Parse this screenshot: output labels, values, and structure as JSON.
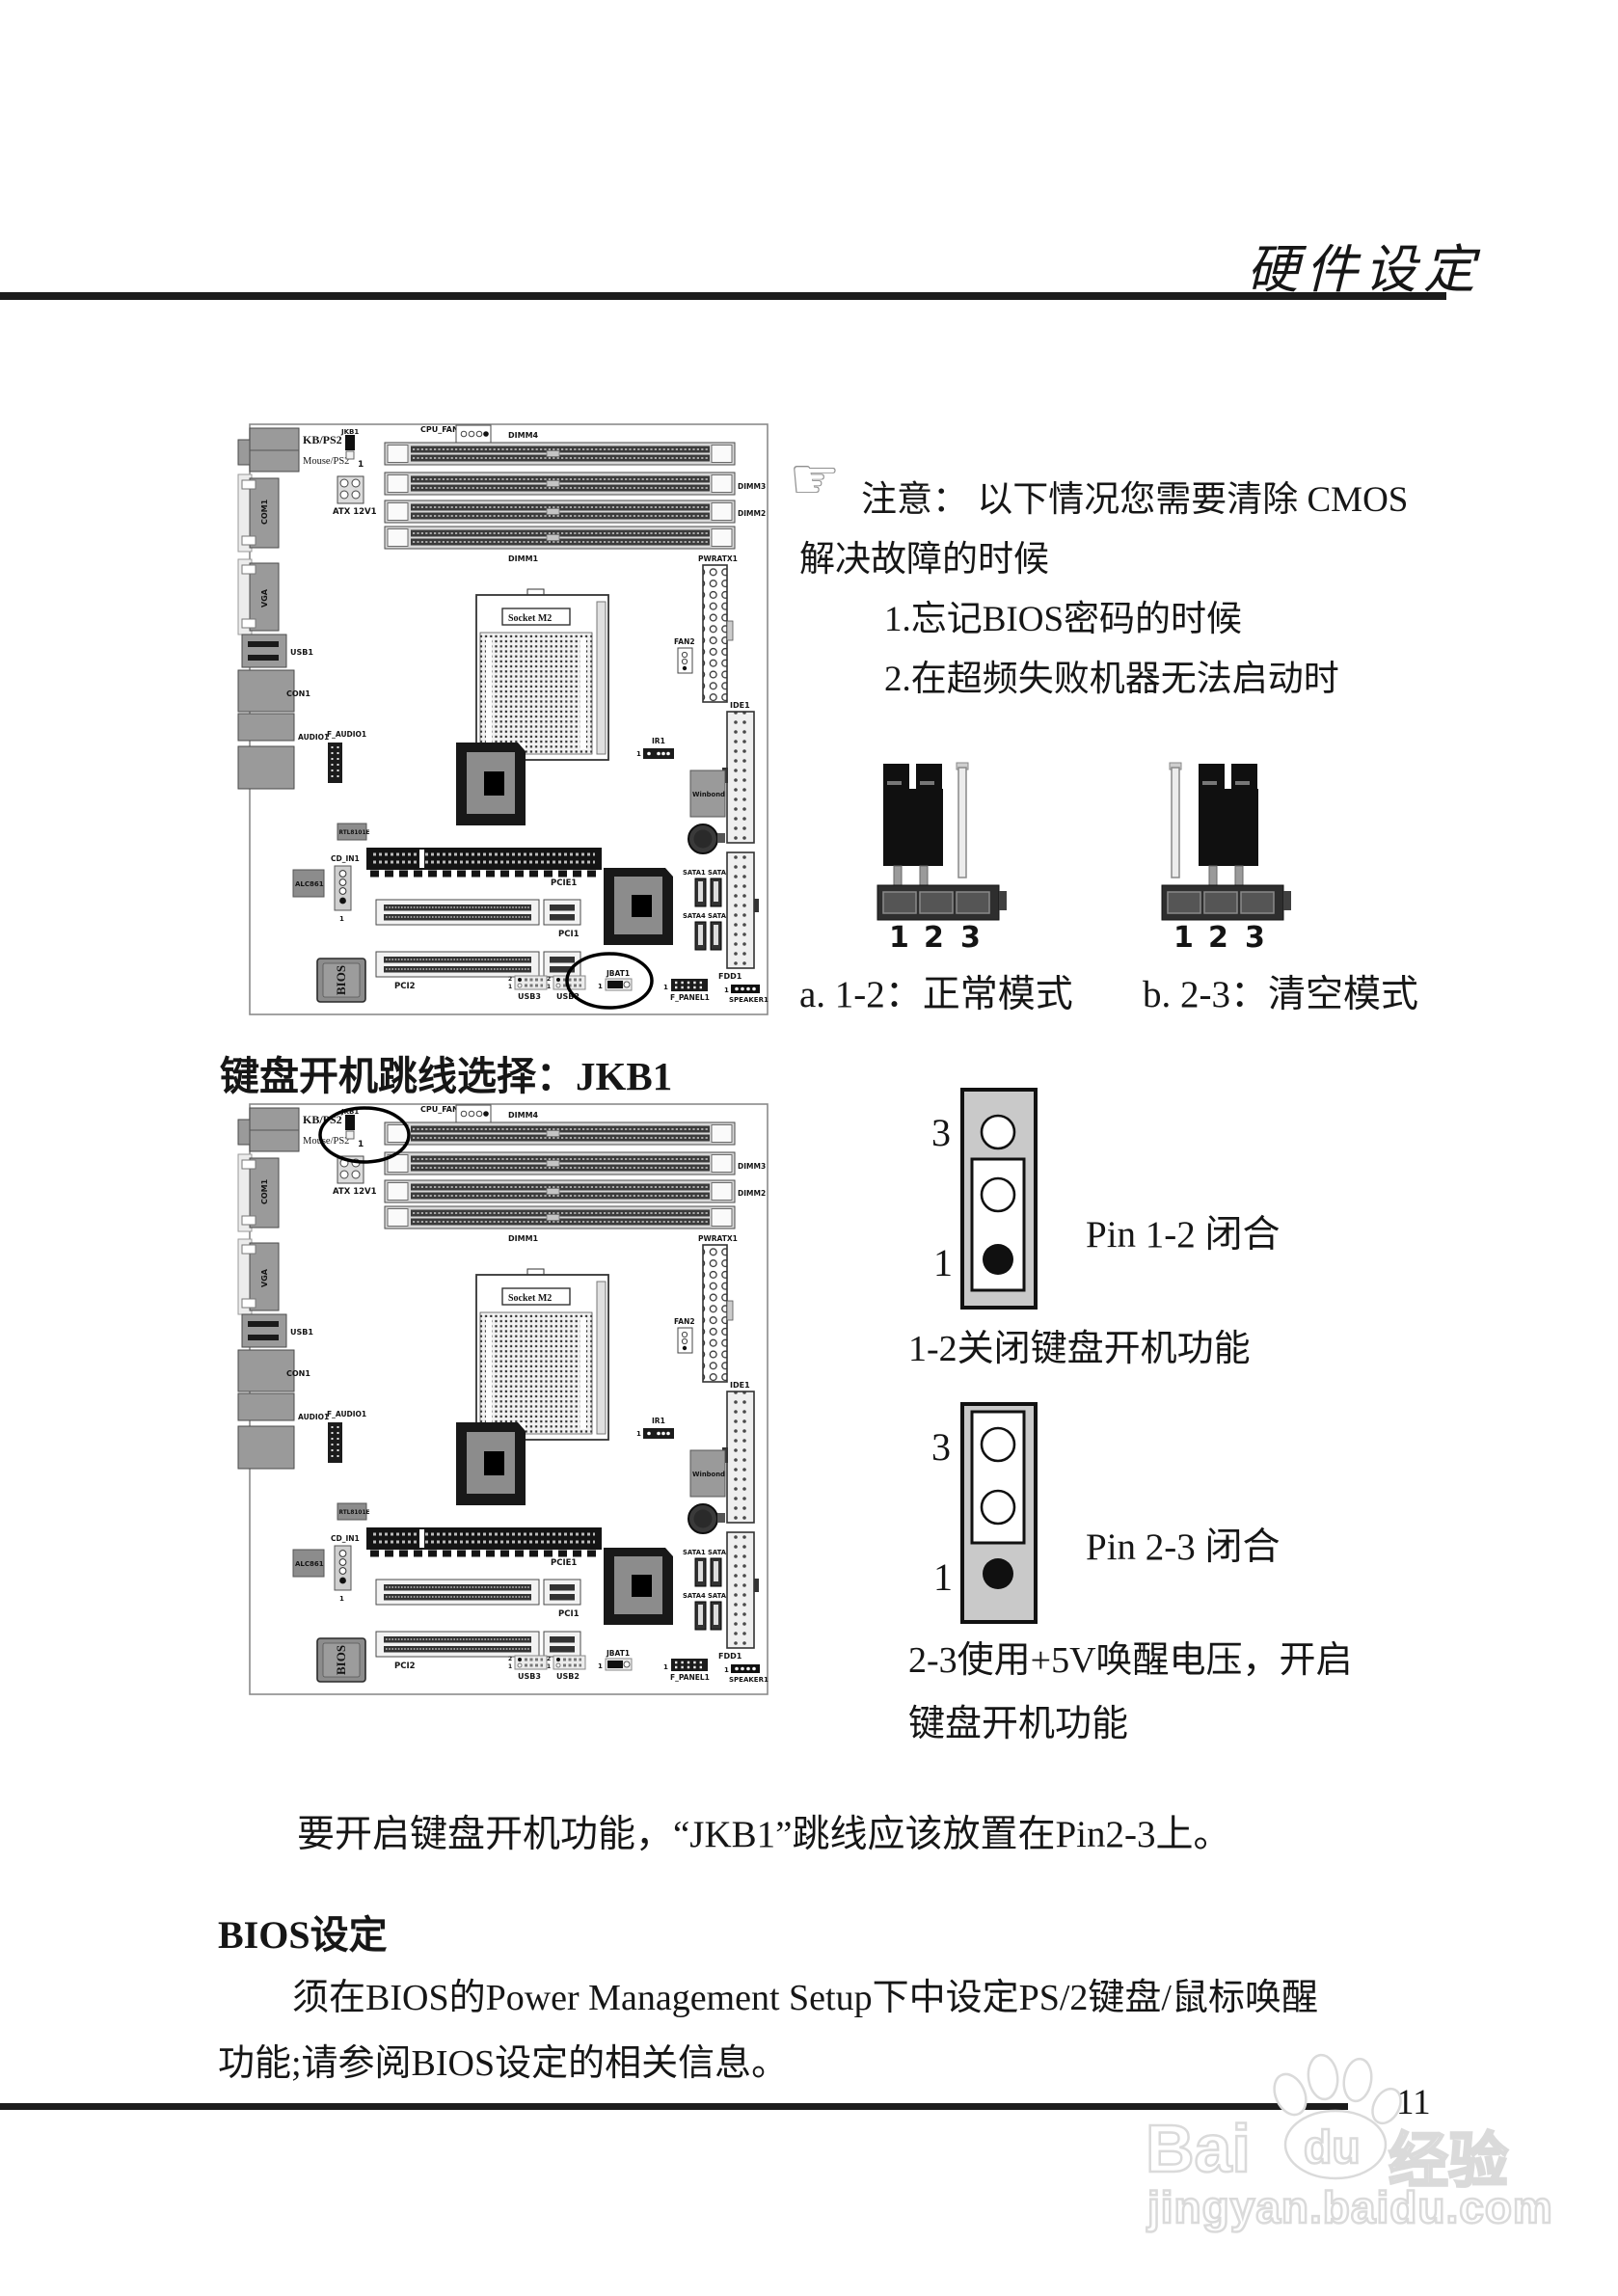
{
  "page": {
    "title": "硬件设定",
    "number": "11"
  },
  "notice": {
    "line1": "注意： 以下情况您需要清除 CMOS",
    "line2": "解决故障的时候",
    "item1": "1.忘记BIOS密码的时候",
    "item2": "2.在超频失败机器无法启动时"
  },
  "cmos_jumper": {
    "pins": [
      "1",
      "2",
      "3"
    ],
    "caption_a": "a. 1-2：正常模式",
    "caption_b": "b. 2-3：清空模式"
  },
  "jkb1": {
    "heading": "键盘开机跳线选择：JKB1",
    "diagram1": {
      "top": "3",
      "bottom": "1",
      "caption": "Pin 1-2 闭合",
      "desc": "1-2关闭键盘开机功能"
    },
    "diagram2": {
      "top": "3",
      "bottom": "1",
      "caption": "Pin 2-3 闭合",
      "desc1": "2-3使用+5V唤醒电压，开启",
      "desc2": "键盘开机功能"
    },
    "note": "要开启键盘开机功能，“JKB1”跳线应该放置在Pin2-3上。"
  },
  "bios": {
    "heading": "BIOS设定",
    "line1": "须在BIOS的Power Management Setup下中设定PS/2键盘/鼠标唤醒",
    "line2": "功能;请参阅BIOS设定的相关信息。"
  },
  "board_labels": {
    "kb_ps2": "KB/PS2",
    "mouse_ps2": "Mouse/PS2",
    "jkb1": "JKB1",
    "pin1": "1",
    "pin2": "2",
    "atx_12v": "ATX 12V1",
    "cpu_fan1": "CPU_FAN1",
    "dimm4": "DIMM4",
    "dimm3": "DIMM3",
    "dimm2": "DIMM2",
    "dimm1": "DIMM1",
    "com1": "COM1",
    "vga": "VGA",
    "usb1": "USB1",
    "con1": "CON1",
    "audio1": "AUDIO1",
    "f_audio1": "F_AUDIO1",
    "socket": "Socket M2",
    "pwratx1": "PWRATX1",
    "fan2": "FAN2",
    "ide1": "IDE1",
    "ir1": "IR1",
    "winbond": "Winbond",
    "rtl8101e": "RTL8101E",
    "cd_in1": "CD_IN1",
    "alc861": "ALC861",
    "pcie1": "PCIE1",
    "pci1": "PCI1",
    "pci2": "PCI2",
    "bios_chip": "BIOS",
    "usb3": "USB3",
    "usb2": "USB2",
    "jbat1": "JBAT1",
    "f_panel1": "F_PANEL1",
    "fdd1": "FDD1",
    "speaker1": "SPEAKER1",
    "sata1": "SATA1",
    "sata2": "SATA2",
    "sata3": "SATA3",
    "sata4": "SATA4"
  },
  "board1": {
    "highlighted_jumper": "JBAT1"
  },
  "board2": {
    "highlighted_jumper": "JKB1"
  },
  "watermark": {
    "bai": "Bai",
    "du": "du",
    "brand": "经验",
    "url": "jingyan.baidu.com"
  }
}
